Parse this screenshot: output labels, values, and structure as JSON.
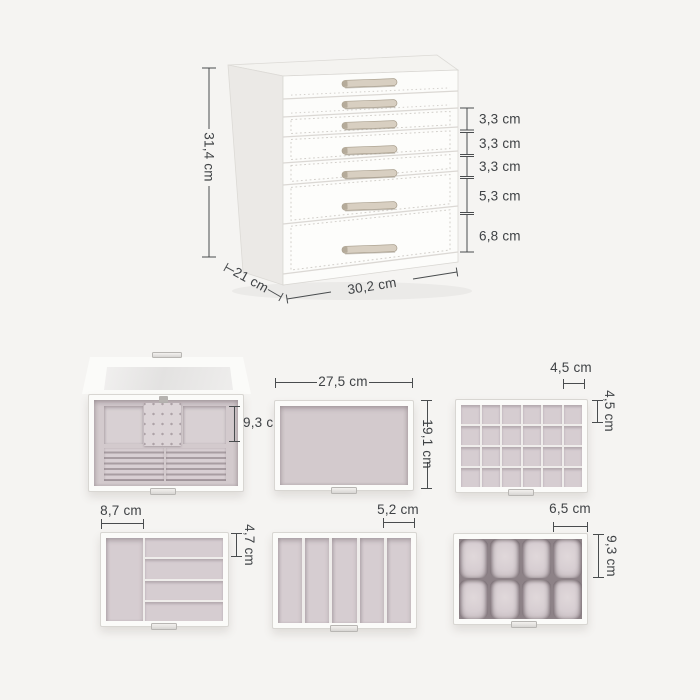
{
  "main_box": {
    "height": "31,4 cm",
    "depth": "21 cm",
    "width": "30,2 cm",
    "drawer_heights": [
      "3,3 cm",
      "3,3 cm",
      "3,3 cm",
      "5,3 cm",
      "6,8 cm"
    ]
  },
  "interior_views": {
    "top_compartment": {
      "depth": "9,3 cm"
    },
    "empty_drawer": {
      "width": "27,5 cm",
      "depth": "19,1 cm"
    },
    "grid_drawer": {
      "cell_width": "4,5 cm",
      "cell_height": "4,5 cm"
    },
    "divided_drawer": {
      "compartment_width": "8,7 cm",
      "row_height": "4,7 cm"
    },
    "slot_drawer": {
      "slot_width": "5,2 cm"
    },
    "watch_drawer": {
      "pillow_width": "6,5 cm",
      "pillow_height": "9,3 cm"
    }
  },
  "colors": {
    "background": "#f5f4f2",
    "box_white": "#fbfbf9",
    "velvet": "#d3cacd",
    "handle_beige": "#d8cfc1",
    "dimension_text": "#3f4245"
  }
}
